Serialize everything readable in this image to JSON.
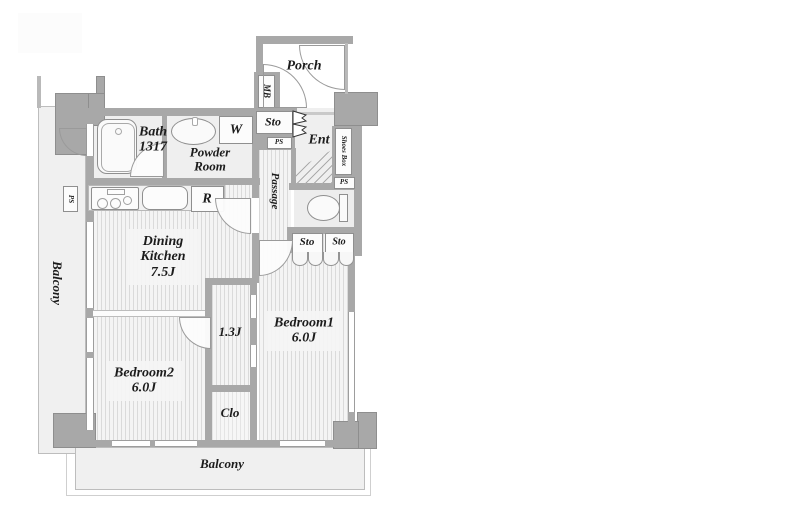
{
  "colors": {
    "wall": "#a8a8a8",
    "wall-light": "#b9b9b9",
    "floor": "#efefef",
    "balcony": "#f0f0f0",
    "stripe-dark": "#dadada",
    "stripe-light": "#f4f4f4",
    "text": "#1c1c1c"
  },
  "plan": {
    "balcony_left": {
      "label": "Balcony"
    },
    "balcony_bottom": {
      "label": "Balcony"
    },
    "porch": {
      "label": "Porch"
    },
    "meter_box": {
      "label": "MB"
    },
    "entrance": {
      "label": "Ent"
    },
    "shoes_box": {
      "label": "Shoes Box"
    },
    "storage_entry": {
      "label": "Sto"
    },
    "pipe_space_entry": {
      "label": "PS"
    },
    "pipe_space_shoes": {
      "label": "PS"
    },
    "pipe_space_kitchen": {
      "label": "PS"
    },
    "bath": {
      "label": "Bath",
      "size": "1317"
    },
    "powder_room": {
      "line1": "Powder",
      "line2": "Room"
    },
    "washer": {
      "label": "W"
    },
    "refrigerator": {
      "label": "R"
    },
    "passage": {
      "label": "Passage"
    },
    "dining_kitchen": {
      "line1": "Dining",
      "line2": "Kitchen",
      "size": "7.5J"
    },
    "storage_hall_left": {
      "label": "Sto"
    },
    "storage_hall_right": {
      "label": "Sto"
    },
    "bedroom1": {
      "label": "Bedroom1",
      "size": "6.0J"
    },
    "bedroom2": {
      "label": "Bedroom2",
      "size": "6.0J"
    },
    "corridor": {
      "size": "1.3J"
    },
    "closet": {
      "label": "Clo"
    }
  }
}
